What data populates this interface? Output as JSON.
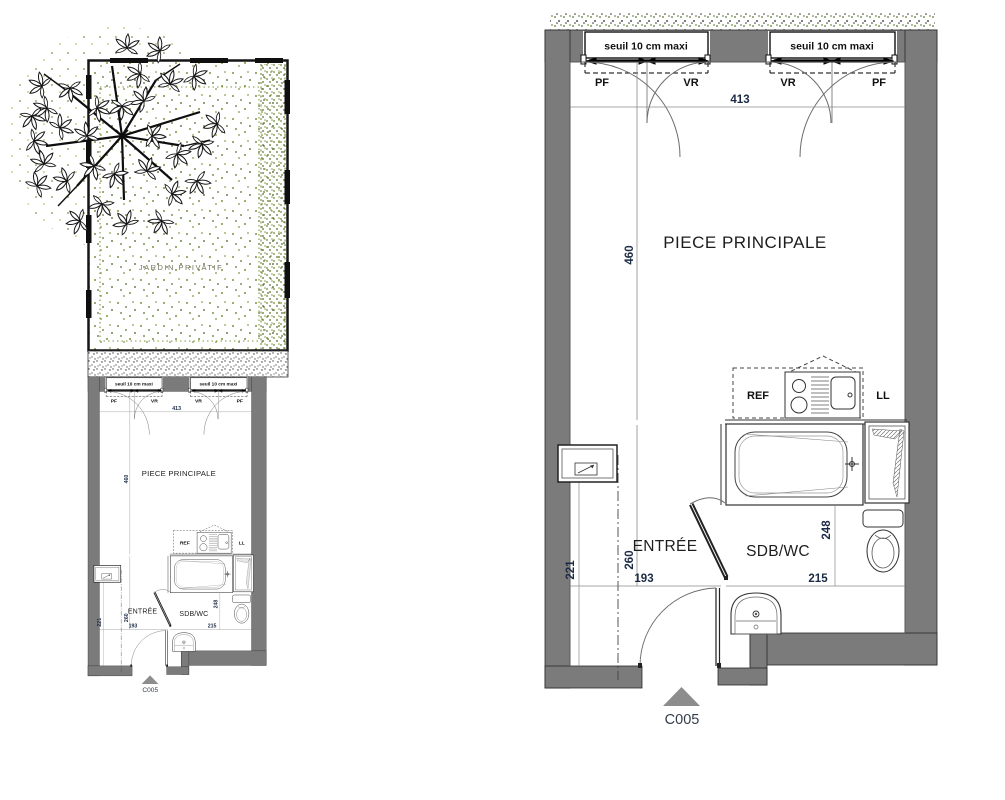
{
  "unit": {
    "code": "C005"
  },
  "garden": {
    "label": "JARDIN PRIVATIF"
  },
  "windows": {
    "sill_note": "seuil 10 cm maxi",
    "pf": "PF",
    "vr": "VR"
  },
  "rooms": {
    "main": "PIECE PRINCIPALE",
    "entry": "ENTRÉE",
    "bathroom": "SDB/WC"
  },
  "appliances": {
    "fridge": "REF",
    "washer": "LL"
  },
  "dims": {
    "main_width": "413",
    "main_depth": "460",
    "entry_axis": "260",
    "closet_depth": "221",
    "entry_width": "193",
    "bath_width": "215",
    "bath_depth": "248"
  },
  "colors": {
    "wall": "#7b7b7b",
    "dim_text": "#1b2a45",
    "garden_green": "#7d9440",
    "marker": "#8d8d8d"
  }
}
